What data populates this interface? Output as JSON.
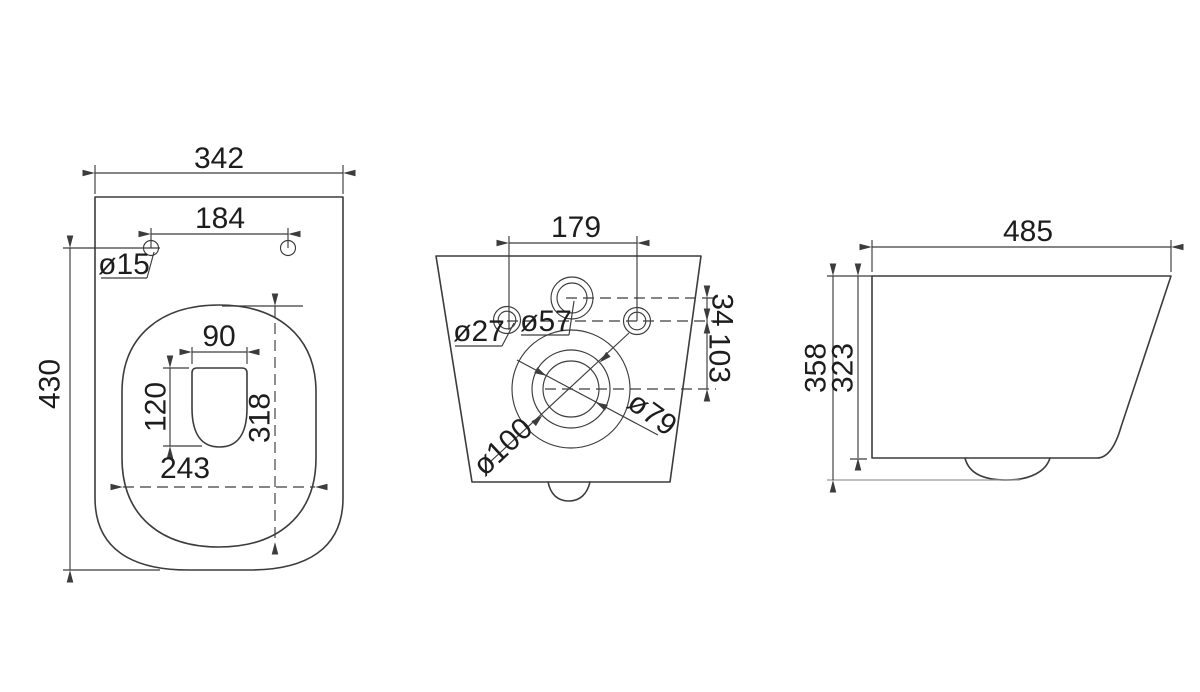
{
  "drawing": {
    "description": "Wall-hung toilet technical drawing, three orthographic views with millimetre dimensions",
    "views": {
      "top_view": {
        "name": "top view",
        "dims": {
          "overall_width": "342",
          "hole_spacing": "184",
          "hole_diameter": "ø15",
          "overall_depth": "430",
          "bowl_opening_width": "90",
          "bowl_opening_depth": "120",
          "inner_rim_depth": "318",
          "inner_rim_width": "243"
        }
      },
      "rear_view": {
        "name": "rear view",
        "dims": {
          "inlet_hole_spacing": "179",
          "side_hole_diameter": "ø27",
          "water_inlet_diameter": "ø57",
          "inlet_vertical_offset": "34",
          "side_hole_to_drain_offset": "103",
          "drain_outer_diameter": "ø100",
          "drain_inner_diameter": "ø79"
        }
      },
      "side_view": {
        "name": "side view",
        "dims": {
          "overall_depth": "485",
          "overall_height": "358",
          "body_height": "323"
        }
      }
    },
    "line_color": "#3c3c3c",
    "background_color": "#ffffff"
  }
}
